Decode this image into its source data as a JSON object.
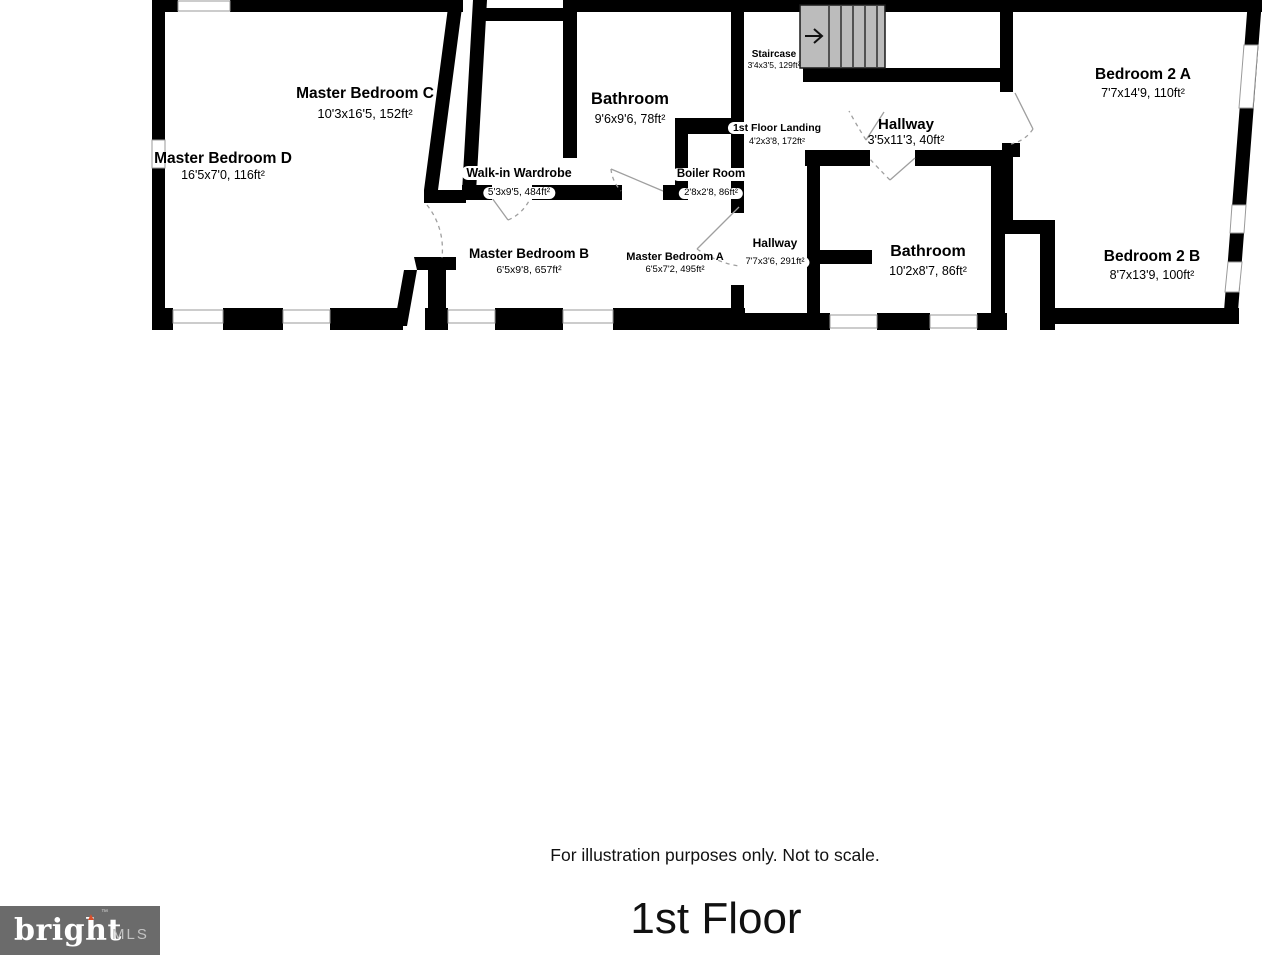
{
  "plan": {
    "rooms": [
      {
        "id": "master-bedroom-d",
        "name": "Master Bedroom D",
        "dims": "16'5x7'0, 116ft²"
      },
      {
        "id": "master-bedroom-c",
        "name": "Master Bedroom C",
        "dims": "10'3x16'5, 152ft²"
      },
      {
        "id": "walk-in-wardrobe",
        "name": "Walk-in Wardrobe",
        "dims": "5'3x9'5, 484ft²"
      },
      {
        "id": "bathroom-upper",
        "name": "Bathroom",
        "dims": "9'6x9'6, 78ft²"
      },
      {
        "id": "boiler-room",
        "name": "Boiler Room",
        "dims": "2'8x2'8, 86ft²"
      },
      {
        "id": "first-floor-landing",
        "name": "1st Floor Landing",
        "dims": "4'2x3'8, 172ft²"
      },
      {
        "id": "staircase",
        "name": "Staircase",
        "dims": "3'4x3'5, 129ft²"
      },
      {
        "id": "hallway-upper",
        "name": "Hallway",
        "dims": "3'5x11'3, 40ft²"
      },
      {
        "id": "hallway-lower",
        "name": "Hallway",
        "dims": "7'7x3'6, 291ft²"
      },
      {
        "id": "master-bedroom-b",
        "name": "Master Bedroom B",
        "dims": "6'5x9'8, 657ft²"
      },
      {
        "id": "master-bedroom-a",
        "name": "Master Bedroom A",
        "dims": "6'5x7'2, 495ft²"
      },
      {
        "id": "bathroom-right",
        "name": "Bathroom",
        "dims": "10'2x8'7, 86ft²"
      },
      {
        "id": "bedroom-2a",
        "name": "Bedroom 2 A",
        "dims": "7'7x14'9, 110ft²"
      },
      {
        "id": "bedroom-2b",
        "name": "Bedroom 2 B",
        "dims": "8'7x13'9, 100ft²"
      }
    ],
    "stair_direction": "right"
  },
  "footer": {
    "disclaimer": "For illustration purposes only. Not to scale.",
    "floor_title": "1st Floor"
  },
  "logo": {
    "brand": "bright",
    "tm": "™",
    "suffix": "MLS"
  },
  "colors": {
    "wall": "#000000",
    "stair_fill": "#bcbcbc",
    "door_swing": "#9f9f9f",
    "window_frame": "#9a9a9a",
    "logo_bg": "#6b6b6b",
    "logo_text": "#ffffff",
    "logo_suffix": "#c3c3c3",
    "logo_accent": "#d94f2b"
  }
}
